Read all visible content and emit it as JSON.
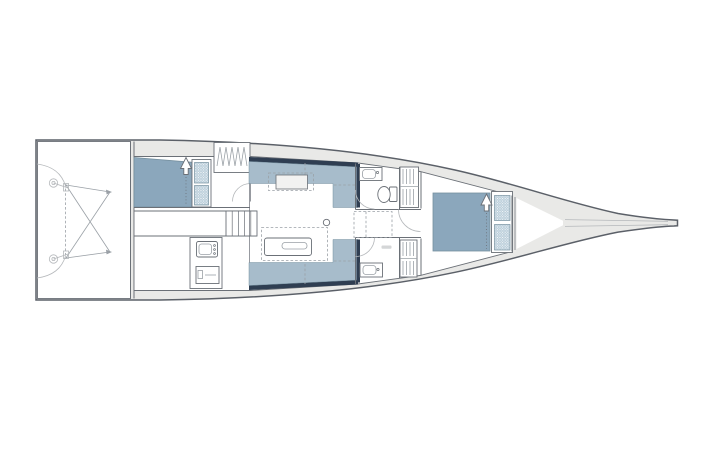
{
  "canvas": {
    "width": 712,
    "height": 456,
    "background": "#ffffff"
  },
  "plan_type": "sailing-yacht-interior-layout",
  "orientation": {
    "bow": "right",
    "stern": "left"
  },
  "colors": {
    "hull_fill": "#e9e9e7",
    "hull_outline": "#5b6068",
    "wall": "#6b7077",
    "wall_light": "#9aa0a6",
    "hinge": "#b5b8bb",
    "floor": "#ffffff",
    "bed": "#8ba7bc",
    "bed_border": "#76909f",
    "settee": "#a7bccb",
    "cushion_border": "#2f3e52",
    "pillow": "#bccfdb",
    "smudge": "#d4d6d7"
  },
  "rooms": {
    "transom_garage": {
      "label": "transom-garage"
    },
    "aft_cabin": {
      "label": "aft-cabin"
    },
    "companionway": {
      "label": "companionway-stairs"
    },
    "galley": {
      "label": "galley"
    },
    "salon": {
      "label": "salon"
    },
    "head_top": {
      "label": "head-port"
    },
    "head_bottom": {
      "label": "head-starboard"
    },
    "forward_cabin": {
      "label": "forward-cabin"
    },
    "bow_locker": {
      "label": "bow-locker"
    }
  },
  "symbols": {
    "double_bed": "blue rectangle with pillows and entry arrow",
    "settee": "L-shaped blue bench with dark outer cushion band",
    "table": "dashed outline with solid rounded top",
    "wardrobe": "box with zigzag hanger strokes",
    "locker": "box with vertical hatch lines",
    "stairs": "box with step lines",
    "door": "quarter-circle swing arc",
    "toilet": "oval bowl with cistern",
    "sink": "small basin rectangle with tap dot",
    "stove": "rectangle with handle",
    "transom_door": "dashed pivot line with crossed swing lines and hinges",
    "mast_post": "small circle"
  }
}
